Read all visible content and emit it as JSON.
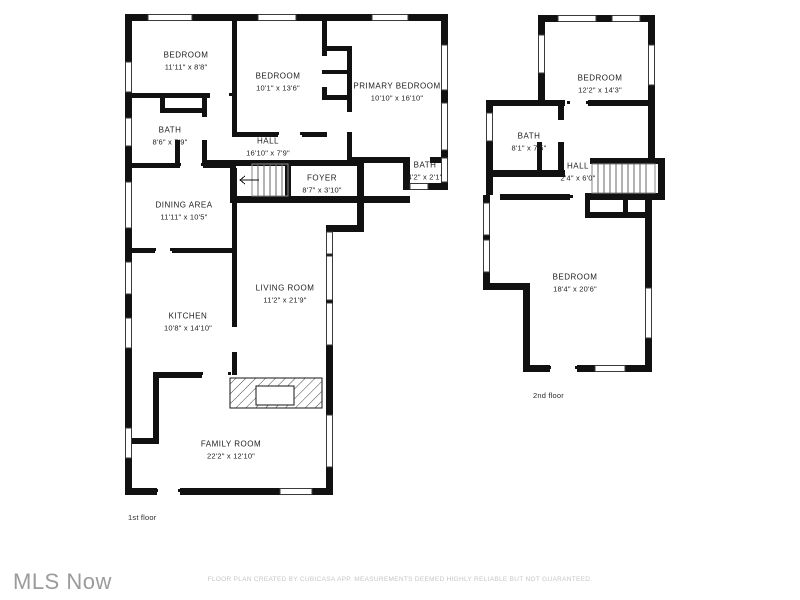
{
  "footer": {
    "logo": "MLS Now",
    "disclaimer": "FLOOR PLAN CREATED BY CUBICASA APP. MEASUREMENTS DEEMED HIGHLY RELIABLE BUT NOT GUARANTEED."
  },
  "colors": {
    "wall": "#111111",
    "label_text": "#1c1c1c",
    "logo_gray": "#9b9b9b",
    "disclaimer_gray": "#c6c6c6"
  },
  "floors": {
    "first": {
      "label": "1st floor",
      "rooms": {
        "bedroom1": {
          "name": "BEDROOM",
          "dims": "11'11\" x 8'8\""
        },
        "bedroom2": {
          "name": "BEDROOM",
          "dims": "10'1\" x 13'6\""
        },
        "primary": {
          "name": "PRIMARY BEDROOM",
          "dims": "10'10\" x 16'10\""
        },
        "bath1": {
          "name": "BATH",
          "dims": "8'6\" x 7'9\""
        },
        "hall": {
          "name": "HALL",
          "dims": "16'10\" x 7'9\""
        },
        "bath2": {
          "name": "BATH",
          "dims": "4'2\" x 2'1\""
        },
        "foyer": {
          "name": "FOYER",
          "dims": "8'7\" x 3'10\""
        },
        "dining": {
          "name": "DINING AREA",
          "dims": "11'11\" x 10'5\""
        },
        "kitchen": {
          "name": "KITCHEN",
          "dims": "10'8\" x 14'10\""
        },
        "living": {
          "name": "LIVING ROOM",
          "dims": "11'2\" x 21'9\""
        },
        "family": {
          "name": "FAMILY ROOM",
          "dims": "22'2\" x 12'10\""
        }
      }
    },
    "second": {
      "label": "2nd floor",
      "rooms": {
        "bedroom3": {
          "name": "BEDROOM",
          "dims": "12'2\" x 14'3\""
        },
        "bath3": {
          "name": "BATH",
          "dims": "8'1\" x 7'5\""
        },
        "hall2": {
          "name": "HALL",
          "dims": "2'4\" x 6'0\""
        },
        "bedroom4": {
          "name": "BEDROOM",
          "dims": "18'4\" x 20'6\""
        }
      }
    }
  }
}
